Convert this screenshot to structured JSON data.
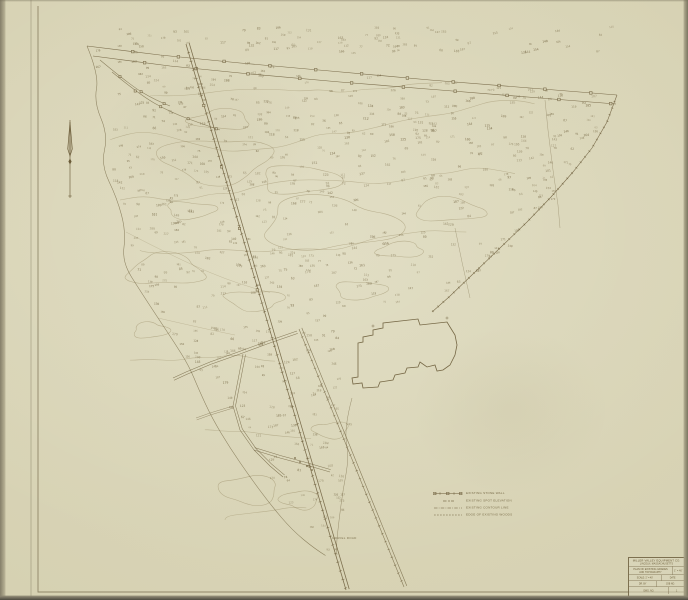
{
  "colors": {
    "paper": "#d7d2b4",
    "paper_light": "#ded9bf",
    "paper_edge": "#b2ac8e",
    "ink": "#6a5b38",
    "ink_light": "#8a7b52"
  },
  "legend": {
    "rows": [
      {
        "symbol": "stone-wall-line-symbol",
        "label": "EXISTING STONE WALL"
      },
      {
        "symbol": "spot-elevation-symbol",
        "label": "EXISTING SPOT ELEVATION"
      },
      {
        "symbol": "contour-line-symbol",
        "label": "EXISTING CONTOUR LINE"
      },
      {
        "symbol": "woods-edge-symbol",
        "label": "EDGE OF EXISTING WOODS"
      }
    ]
  },
  "title_block": {
    "company_line1": "MILLER VALLEY EQUIPMENT CO.",
    "company_line2": "LINCOLN, MASSACHUSETTS",
    "title_line1": "PLAN OF EXISTING GRADES",
    "title_line2": "AND TOPOGRAPHY",
    "scale_value": "1\" = 40'",
    "cells": {
      "c1": "SCALE: 1\" = 40'",
      "c2": "DATE",
      "c3": "DR. BY",
      "c4": "JOB NO.",
      "c5": "DWG. NO.",
      "c6": "1"
    }
  },
  "map": {
    "road_label": "GRAVEL ROAD",
    "spot_marks": {
      "count": 640,
      "band_count": 80,
      "seed": 11,
      "min_value": 62,
      "max_value": 188
    }
  }
}
